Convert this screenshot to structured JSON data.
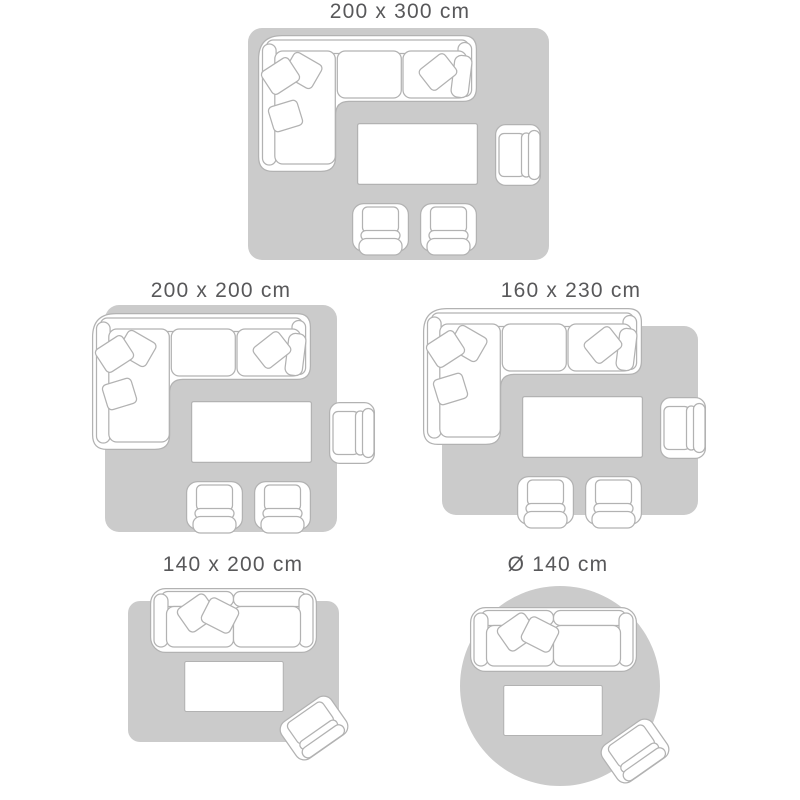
{
  "guide": {
    "panels": [
      {
        "id": "200x300",
        "label": "200 x 300 cm",
        "rug_shape": "rectangular",
        "furniture": [
          "sectional-sofa",
          "throw-pillows",
          "coffee-table",
          "armchair",
          "club-chair",
          "club-chair"
        ]
      },
      {
        "id": "200x200",
        "label": "200 x 200 cm",
        "rug_shape": "rectangular",
        "furniture": [
          "sectional-sofa",
          "throw-pillows",
          "coffee-table",
          "armchair",
          "club-chair",
          "club-chair"
        ]
      },
      {
        "id": "160x230",
        "label": "160 x 230 cm",
        "rug_shape": "rectangular",
        "furniture": [
          "sectional-sofa",
          "throw-pillows",
          "coffee-table",
          "armchair",
          "club-chair",
          "club-chair"
        ]
      },
      {
        "id": "140x200",
        "label": "140 x 200 cm",
        "rug_shape": "rectangular",
        "furniture": [
          "two-seater-sofa",
          "throw-pillows",
          "coffee-table",
          "armchair"
        ]
      },
      {
        "id": "diameter-140",
        "label": "Ø 140 cm",
        "rug_shape": "round",
        "furniture": [
          "two-seater-sofa",
          "throw-pillows",
          "coffee-table",
          "armchair"
        ]
      }
    ]
  },
  "colors": {
    "background": "#ffffff",
    "rug": "#cbcbcb",
    "outline": "#b2b2b2",
    "furniture_fill": "#ffffff",
    "label_text": "#58585a"
  }
}
